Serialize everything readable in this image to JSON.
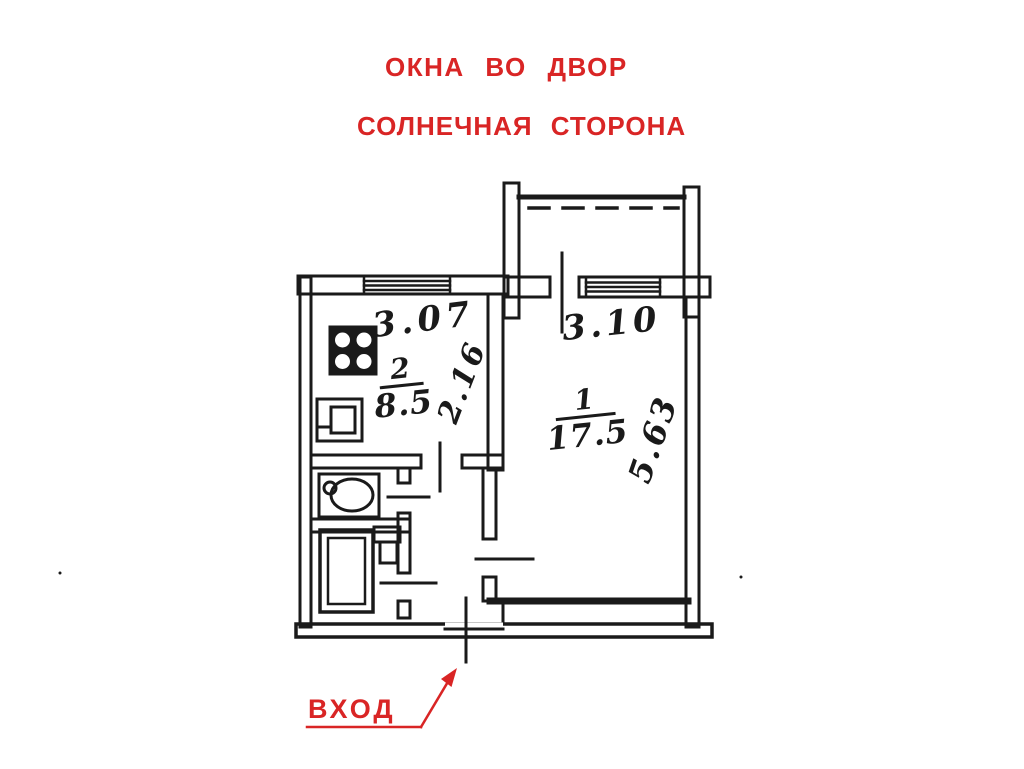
{
  "annotations": {
    "top_note_line1": "ОКНА  ВО  ДВОР",
    "top_note_line2": "СОЛНЕЧНАЯ  СТОРОНА",
    "entrance_label": "ВХОД",
    "annotation_color": "#d92525"
  },
  "floor_plan": {
    "ink_color": "#1a1a1a",
    "background_color": "#ffffff",
    "rooms": [
      {
        "name": "living-room",
        "number": "1",
        "area_sq_m": "17.5",
        "width_m": "3.10",
        "depth_m": "5.63"
      },
      {
        "name": "kitchen",
        "number": "2",
        "area_sq_m": "8.5",
        "width_m": "3.07",
        "depth_m": "2.16"
      }
    ],
    "fixtures": [
      "stove-icon",
      "kitchen-sink-icon",
      "washbasin-icon",
      "bathtub-icon",
      "toilet-icon"
    ],
    "features": [
      "balcony",
      "balcony-door-mark",
      "kitchen-window",
      "living-room-window",
      "entrance-door-mark",
      "bathroom",
      "toilet-room",
      "hallway"
    ]
  }
}
